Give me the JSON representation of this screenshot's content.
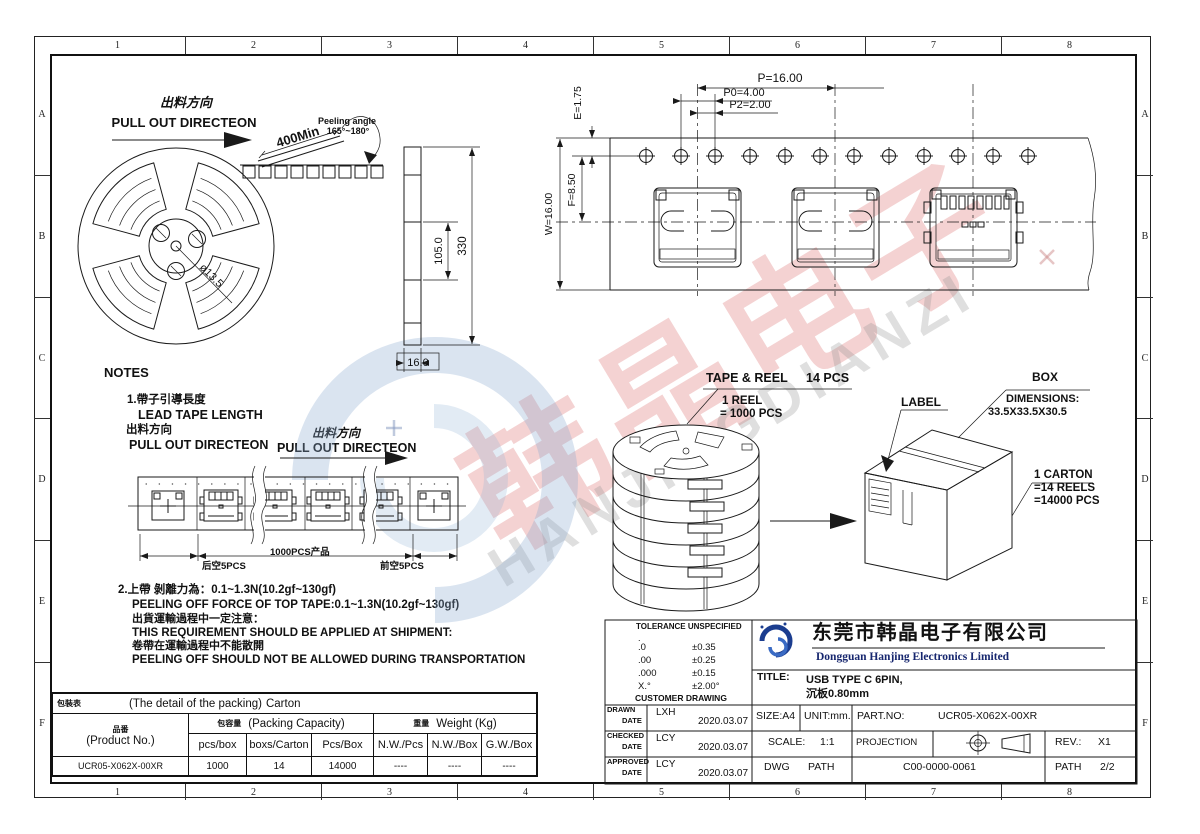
{
  "border": {
    "columns": [
      "1",
      "2",
      "3",
      "4",
      "5",
      "6",
      "7",
      "8"
    ],
    "rows": [
      "A",
      "B",
      "C",
      "D",
      "E",
      "F"
    ]
  },
  "watermark": {
    "cn": "韩晶电子",
    "en": "HANJINGDIANZI"
  },
  "reel": {
    "dir_cn": "出料方向",
    "dir_en": "PULL OUT DIRECTEON",
    "min_len": "400Min",
    "peel_label": "Peeling angle",
    "peel_value": "165°~180°",
    "hub_dia": "ø13.5"
  },
  "side": {
    "h": "330",
    "inner": "105.0",
    "w": "16.0"
  },
  "tape": {
    "p": "P=16.00",
    "p0": "P0=4.00",
    "p2": "P2=2.00",
    "e": "E=1.75",
    "f": "F=8.50",
    "w": "W=16.00"
  },
  "notes": {
    "title": "NOTES",
    "n1_cn": "1.帶子引導長度",
    "n1_en": "LEAD TAPE LENGTH",
    "n1b_cn": "出料方向",
    "n1b_en": "PULL OUT DIRECTEON",
    "dir2_cn": "出料方向",
    "dir2_en": "PULL OUT DIRECTEON",
    "empty_back": "后空5PCS",
    "qty": "1000PCS产品",
    "empty_front": "前空5PCS",
    "n2_cn": "2.上帶 剝離力為：0.1~1.3N(10.2gf~130gf)",
    "n2_en": "PEELING OFF FORCE OF TOP TAPE:0.1~1.3N(10.2gf~130gf)",
    "n3_cn": "出貨運輸過程中一定注意：",
    "n3_en": "THIS REQUIREMENT SHOULD BE APPLIED AT SHIPMENT:",
    "n4_cn": "卷帶在運輸過程中不能散開",
    "n4_en": "PEELING OFF SHOULD NOT BE ALLOWED DURING TRANSPORTATION"
  },
  "packout": {
    "tr_label": "TAPE & REEL",
    "tr_qty": "14 PCS",
    "reel1": "1 REEL",
    "reel2": "= 1000 PCS",
    "label": "LABEL",
    "box": "BOX",
    "dim_label": "DIMENSIONS:",
    "dim_value": "33.5X33.5X30.5",
    "carton1": "1 CARTON",
    "carton2": "=14 REELS",
    "carton3": "=14000 PCS"
  },
  "table": {
    "caption_cn": "包裝表",
    "caption_en": "(The detail of the packing)",
    "caption_tail": "Carton",
    "product_cn": "品番",
    "product_en": "(Product No.)",
    "cap_cn": "包容量",
    "cap_en": "(Packing Capacity)",
    "wt_cn": "重量",
    "wt_en": "Weight (Kg)",
    "sub": [
      "pcs/box",
      "boxs/Carton",
      "Pcs/Box",
      "N.W./Pcs",
      "N.W./Box",
      "G.W./Box"
    ],
    "row": [
      "UCR05-X062X-00XR",
      "1000",
      "14",
      "14000",
      "----",
      "----",
      "----"
    ]
  },
  "tb": {
    "tol_title": "TOLERANCE UNSPECIFIED",
    "tol_dot": ".",
    "tol": [
      {
        "k": ".0",
        "v": "±0.35"
      },
      {
        "k": ".00",
        "v": "±0.25"
      },
      {
        "k": ".000",
        "v": "±0.15"
      },
      {
        "k": "X.°",
        "v": "±2.00°"
      }
    ],
    "tol_note": "CUSTOMER DRAWING",
    "company_cn": "东莞市韩晶电子有限公司",
    "company_en": "Dongguan Hanjing Electronics Limited",
    "title_label": "TITLE:",
    "title1": "USB TYPE C 6PIN,",
    "title2": "沉板0.80mm",
    "drawn": "DRAWN",
    "checked": "CHECKED",
    "approved": "APPROVED",
    "date": "DATE",
    "drawn_name": "LXH",
    "drawn_date": "2020.03.07",
    "checked_name": "LCY",
    "checked_date": "2020.03.07",
    "approved_name": "LCY",
    "approved_date": "2020.03.07",
    "size": "SIZE:A4",
    "unit": "UNIT:mm.",
    "pn_label": "PART.NO:",
    "pn": "UCR05-X062X-00XR",
    "scale_label": "SCALE:",
    "scale": "1:1",
    "projection": "PROJECTION",
    "rev_label": "REV.:",
    "rev": "X1",
    "dwg": "DWG",
    "path": "PATH",
    "doc": "C00-0000-0061",
    "path2": "PATH",
    "sheet": "2/2"
  }
}
